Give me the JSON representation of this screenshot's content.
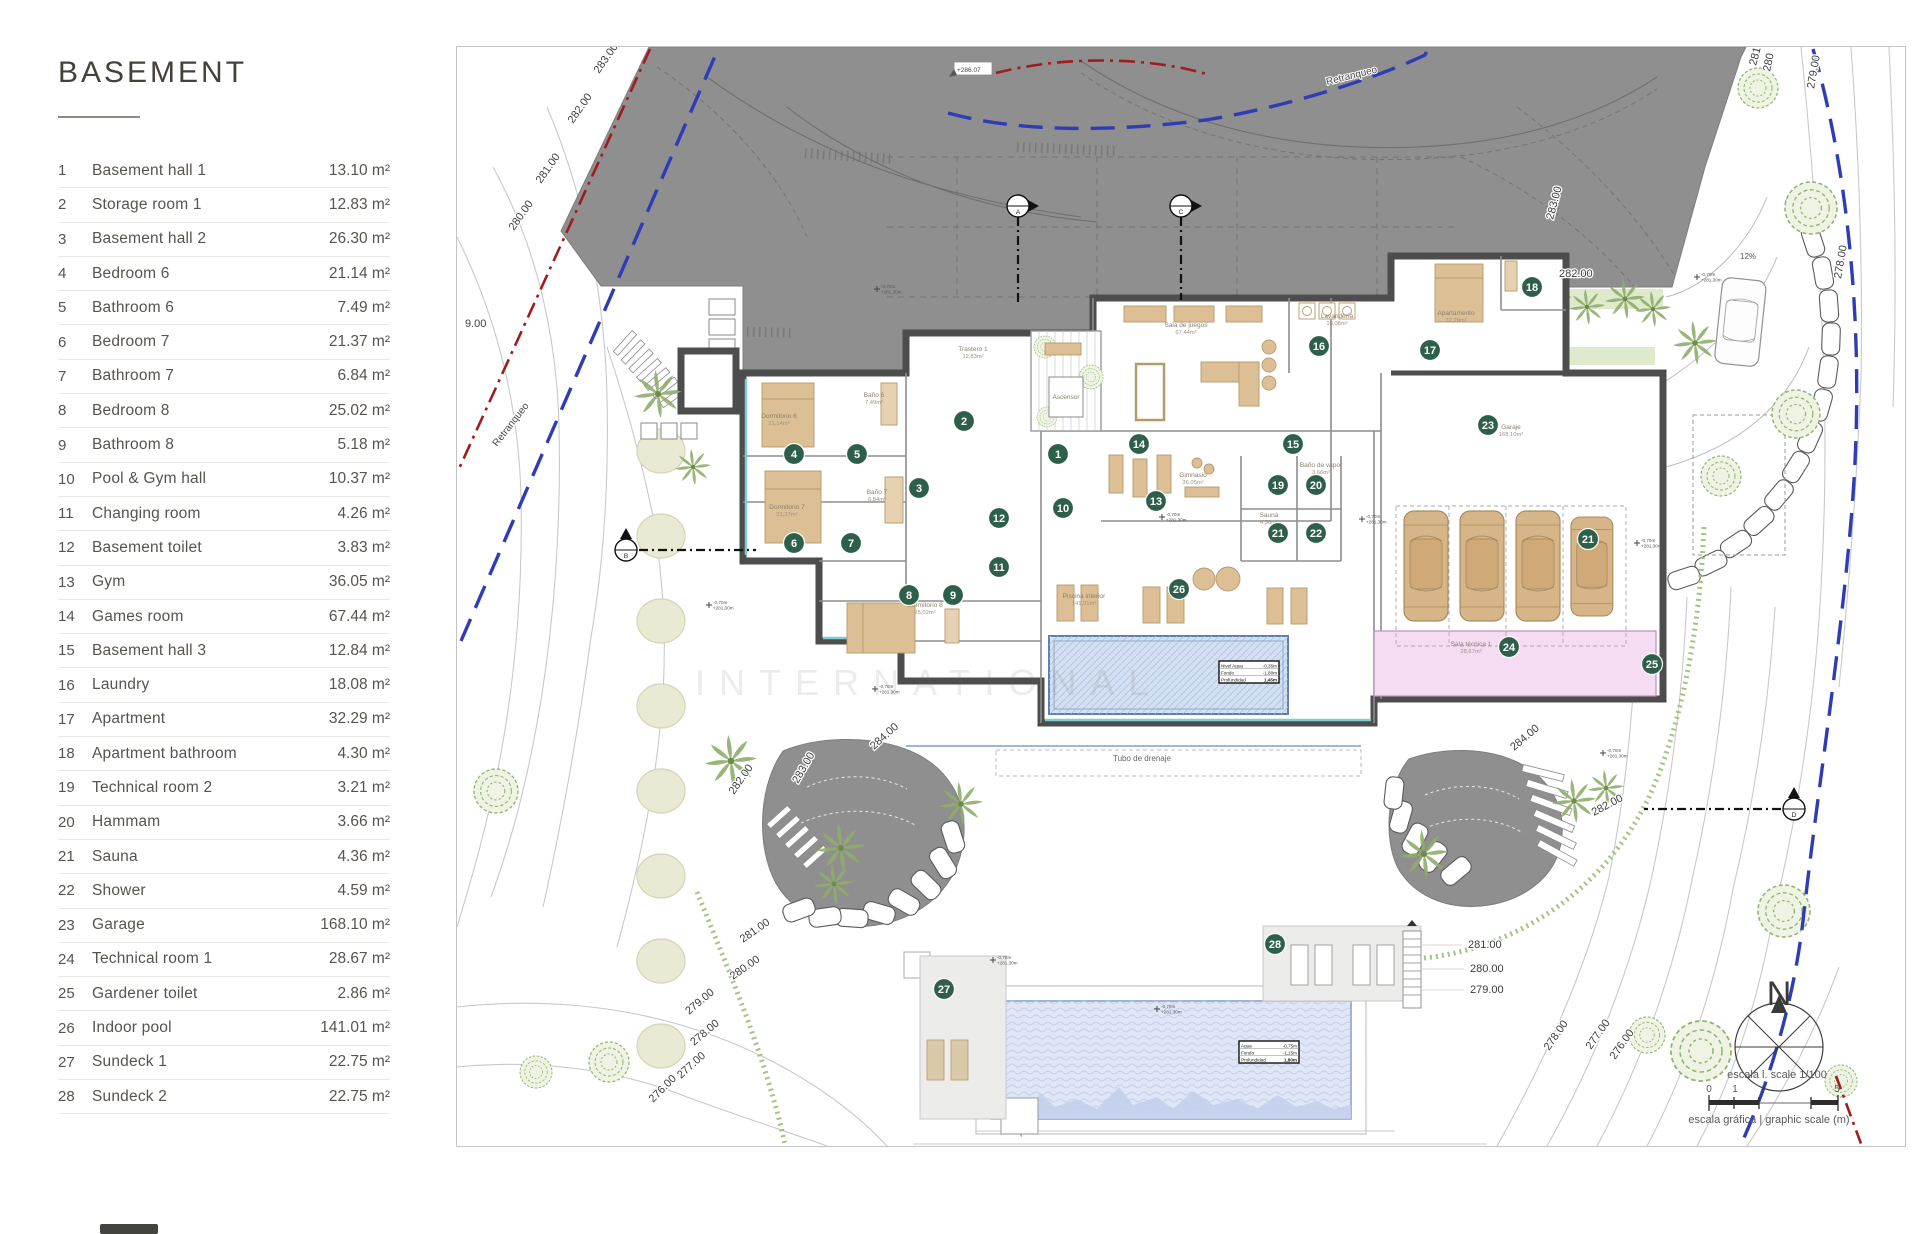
{
  "legend": {
    "title": "BASEMENT",
    "unit": "m²",
    "rooms": [
      {
        "n": 1,
        "name": "Basement hall 1",
        "area": "13.10"
      },
      {
        "n": 2,
        "name": "Storage room 1",
        "area": "12.83"
      },
      {
        "n": 3,
        "name": "Basement hall 2",
        "area": "26.30"
      },
      {
        "n": 4,
        "name": "Bedroom 6",
        "area": "21.14"
      },
      {
        "n": 5,
        "name": "Bathroom 6",
        "area": "7.49"
      },
      {
        "n": 6,
        "name": "Bedroom 7",
        "area": "21.37"
      },
      {
        "n": 7,
        "name": "Bathroom 7",
        "area": "6.84"
      },
      {
        "n": 8,
        "name": "Bedroom 8",
        "area": "25.02"
      },
      {
        "n": 9,
        "name": "Bathroom 8",
        "area": "5.18"
      },
      {
        "n": 10,
        "name": "Pool & Gym hall",
        "area": "10.37"
      },
      {
        "n": 11,
        "name": "Changing room",
        "area": "4.26"
      },
      {
        "n": 12,
        "name": "Basement toilet",
        "area": "3.83"
      },
      {
        "n": 13,
        "name": "Gym",
        "area": "36.05"
      },
      {
        "n": 14,
        "name": "Games room",
        "area": "67.44"
      },
      {
        "n": 15,
        "name": "Basement hall 3",
        "area": "12.84"
      },
      {
        "n": 16,
        "name": "Laundry",
        "area": "18.08"
      },
      {
        "n": 17,
        "name": "Apartment",
        "area": "32.29"
      },
      {
        "n": 18,
        "name": "Apartment bathroom",
        "area": "4.30"
      },
      {
        "n": 19,
        "name": "Technical room 2",
        "area": "3.21"
      },
      {
        "n": 20,
        "name": "Hammam",
        "area": "3.66"
      },
      {
        "n": 21,
        "name": "Sauna",
        "area": "4.36"
      },
      {
        "n": 22,
        "name": "Shower",
        "area": "4.59"
      },
      {
        "n": 23,
        "name": "Garage",
        "area": "168.10"
      },
      {
        "n": 24,
        "name": "Technical room 1",
        "area": "28.67"
      },
      {
        "n": 25,
        "name": "Gardener toilet",
        "area": "2.86"
      },
      {
        "n": 26,
        "name": "Indoor pool",
        "area": "141.01"
      },
      {
        "n": 27,
        "name": "Sundeck 1",
        "area": "22.75"
      },
      {
        "n": 28,
        "name": "Sundeck 2",
        "area": "22.75"
      }
    ]
  },
  "plan": {
    "texts": {
      "retranqueo_top": "Retranqueo",
      "retranqueo_left": "Retranqueo",
      "benchmark": "+286.07",
      "slope": "12%",
      "drain": "Tubo de drenaje",
      "north": "N",
      "scale_line1": "escala l. scale 1/100",
      "scale_line2": "escala gráfica |  graphic scale (m)",
      "watermark": "INTERNATIONAL"
    },
    "scale_ticks": [
      "0",
      "1",
      "5"
    ],
    "elevation_labels": [
      {
        "t": "283.00",
        "x": 142,
        "y": 27,
        "r": -55
      },
      {
        "t": "282.00",
        "x": 116,
        "y": 77,
        "r": -55
      },
      {
        "t": "281.00",
        "x": 84,
        "y": 137,
        "r": -55
      },
      {
        "t": "280.00",
        "x": 57,
        "y": 184,
        "r": -55
      },
      {
        "t": "9.00",
        "x": 8,
        "y": 280,
        "r": 0
      },
      {
        "t": "283.00",
        "x": 1096,
        "y": 173,
        "r": -75
      },
      {
        "t": "282.00",
        "x": 1102,
        "y": 230,
        "r": 0
      },
      {
        "t": "281",
        "x": 1299,
        "y": 19,
        "r": -75
      },
      {
        "t": "280",
        "x": 1313,
        "y": 25,
        "r": -78
      },
      {
        "t": "279.00",
        "x": 1357,
        "y": 42,
        "r": -80
      },
      {
        "t": "278.00",
        "x": 1384,
        "y": 232,
        "r": -80
      },
      {
        "t": "284.00",
        "x": 417,
        "y": 703,
        "r": -42
      },
      {
        "t": "283.00",
        "x": 341,
        "y": 737,
        "r": -60
      },
      {
        "t": "282.00",
        "x": 277,
        "y": 748,
        "r": -55
      },
      {
        "t": "281.00",
        "x": 286,
        "y": 896,
        "r": -35
      },
      {
        "t": "280.00",
        "x": 276,
        "y": 933,
        "r": -35
      },
      {
        "t": "279.00",
        "x": 232,
        "y": 968,
        "r": -40
      },
      {
        "t": "278.00",
        "x": 237,
        "y": 999,
        "r": -40
      },
      {
        "t": "277.00",
        "x": 224,
        "y": 1032,
        "r": -42
      },
      {
        "t": "276.00",
        "x": 196,
        "y": 1056,
        "r": -45
      },
      {
        "t": "284.00",
        "x": 1057,
        "y": 704,
        "r": -40
      },
      {
        "t": "282.00",
        "x": 1137,
        "y": 769,
        "r": -28
      },
      {
        "t": "281.00",
        "x": 1011,
        "y": 901,
        "r": 0
      },
      {
        "t": "280.00",
        "x": 1013,
        "y": 925,
        "r": 0
      },
      {
        "t": "279.00",
        "x": 1013,
        "y": 946,
        "r": 0
      },
      {
        "t": "278.00",
        "x": 1092,
        "y": 1004,
        "r": -55
      },
      {
        "t": "277.00",
        "x": 1134,
        "y": 1003,
        "r": -55
      },
      {
        "t": "276.00",
        "x": 1158,
        "y": 1013,
        "r": -55
      }
    ],
    "room_labels": [
      {
        "t": "Sala de juegos",
        "s": "67,44m²",
        "x": 729,
        "y": 280
      },
      {
        "t": "Gimnasio",
        "s": "36,05m²",
        "x": 736,
        "y": 430
      },
      {
        "t": "Garaje",
        "s": "168,10m²",
        "x": 1054,
        "y": 382
      },
      {
        "t": "Piscina interior",
        "s": "141,01m²",
        "x": 627,
        "y": 551
      },
      {
        "t": "Apartamento",
        "s": "32,29m²",
        "x": 999,
        "y": 268
      },
      {
        "t": "Ascensor",
        "s": "",
        "x": 609,
        "y": 352
      },
      {
        "t": "Sala técnica 1",
        "s": "28,67m²",
        "x": 1014,
        "y": 599
      },
      {
        "t": "Lavandería",
        "s": "18,08m²",
        "x": 880,
        "y": 271
      },
      {
        "t": "Trastero 1",
        "s": "12,83m²",
        "x": 516,
        "y": 304
      },
      {
        "t": "Dormitorio 6",
        "s": "21,14m²",
        "x": 322,
        "y": 371
      },
      {
        "t": "Dormitorio 7",
        "s": "21,37m²",
        "x": 330,
        "y": 462
      },
      {
        "t": "Dormitorio 8",
        "s": "25,02m²",
        "x": 468,
        "y": 560
      },
      {
        "t": "Baño 6",
        "s": "7,49m²",
        "x": 417,
        "y": 350
      },
      {
        "t": "Baño 7",
        "s": "6,84m²",
        "x": 420,
        "y": 447
      },
      {
        "t": "Sauna",
        "s": "4,36m²",
        "x": 812,
        "y": 470
      },
      {
        "t": "Baño de vapor",
        "s": "3,66m²",
        "x": 864,
        "y": 420
      }
    ],
    "markers": [
      {
        "num": "1",
        "x": 601,
        "y": 407
      },
      {
        "num": "2",
        "x": 507,
        "y": 374
      },
      {
        "num": "3",
        "x": 462,
        "y": 441
      },
      {
        "num": "4",
        "x": 337,
        "y": 407
      },
      {
        "num": "5",
        "x": 400,
        "y": 407
      },
      {
        "num": "6",
        "x": 337,
        "y": 496
      },
      {
        "num": "7",
        "x": 394,
        "y": 496
      },
      {
        "num": "8",
        "x": 452,
        "y": 548
      },
      {
        "num": "9",
        "x": 496,
        "y": 548
      },
      {
        "num": "10",
        "x": 606,
        "y": 461
      },
      {
        "num": "11",
        "x": 542,
        "y": 520
      },
      {
        "num": "12",
        "x": 542,
        "y": 471
      },
      {
        "num": "13",
        "x": 699,
        "y": 454
      },
      {
        "num": "14",
        "x": 682,
        "y": 397
      },
      {
        "num": "15",
        "x": 836,
        "y": 397
      },
      {
        "num": "16",
        "x": 862,
        "y": 299
      },
      {
        "num": "17",
        "x": 973,
        "y": 303
      },
      {
        "num": "18",
        "x": 1075,
        "y": 240
      },
      {
        "num": "19",
        "x": 821,
        "y": 438
      },
      {
        "num": "20",
        "x": 859,
        "y": 438
      },
      {
        "num": "21",
        "x": 821,
        "y": 486
      },
      {
        "num": "22",
        "x": 859,
        "y": 486
      },
      {
        "num": "23",
        "x": 1031,
        "y": 378
      },
      {
        "num": "24",
        "x": 1052,
        "y": 600
      },
      {
        "num": "25",
        "x": 1195,
        "y": 617
      },
      {
        "num": "26",
        "x": 722,
        "y": 542
      },
      {
        "num": "27",
        "x": 487,
        "y": 942
      },
      {
        "num": "28",
        "x": 818,
        "y": 897
      },
      {
        "num": "21",
        "x": 1131,
        "y": 492
      }
    ],
    "sections": [
      {
        "l": "A",
        "x": 561,
        "y": 159,
        "dir": "down",
        "len": 100
      },
      {
        "l": "C",
        "x": 724,
        "y": 159,
        "dir": "down",
        "len": 94
      },
      {
        "l": "B",
        "x": 169,
        "y": 503,
        "dir": "right",
        "len": 130
      },
      {
        "l": "D",
        "x": 1337,
        "y": 762,
        "dir": "left",
        "len": 150
      }
    ],
    "tiny_marks": [
      {
        "x": 420,
        "y": 242
      },
      {
        "x": 252,
        "y": 558
      },
      {
        "x": 705,
        "y": 470
      },
      {
        "x": 905,
        "y": 472
      },
      {
        "x": 1180,
        "y": 496
      },
      {
        "x": 700,
        "y": 962
      },
      {
        "x": 536,
        "y": 913
      },
      {
        "x": 1240,
        "y": 230
      },
      {
        "x": 1146,
        "y": 706
      },
      {
        "x": 418,
        "y": 642
      }
    ],
    "tiny_mark_lines": [
      "-0,70m",
      "+281,30m"
    ],
    "pool_tables": [
      {
        "x": 762,
        "y": 614,
        "rows": [
          [
            "Nivel Agua",
            "-0,35m"
          ],
          [
            "Fondo",
            "-1,80m"
          ],
          [
            "Profundidad",
            "1,45m"
          ]
        ]
      },
      {
        "x": 782,
        "y": 994,
        "rows": [
          [
            "Agua",
            "-0,75m"
          ],
          [
            "Fondo",
            "-1,15m"
          ],
          [
            "Profundidad",
            "1,80m"
          ]
        ]
      }
    ],
    "colors": {
      "terrain": "#8f8f8f",
      "wall": "#4d4d4d",
      "marker": "#2d5f4b",
      "furniture": "#dcbf94",
      "furniture_stroke": "#b79a6c",
      "pool_water": "#d3dff2",
      "outdoor_water": "#dfe6f6",
      "pink": "#f5dcf2",
      "vegetation": "#8fae6b",
      "hedge": "#9abf72",
      "olive": "#e9e9d4",
      "red_line": "#9e1d1d",
      "blue_line": "#2f3db5",
      "contour": "#c9c9c9",
      "glazing": "#7ccfcf"
    }
  }
}
